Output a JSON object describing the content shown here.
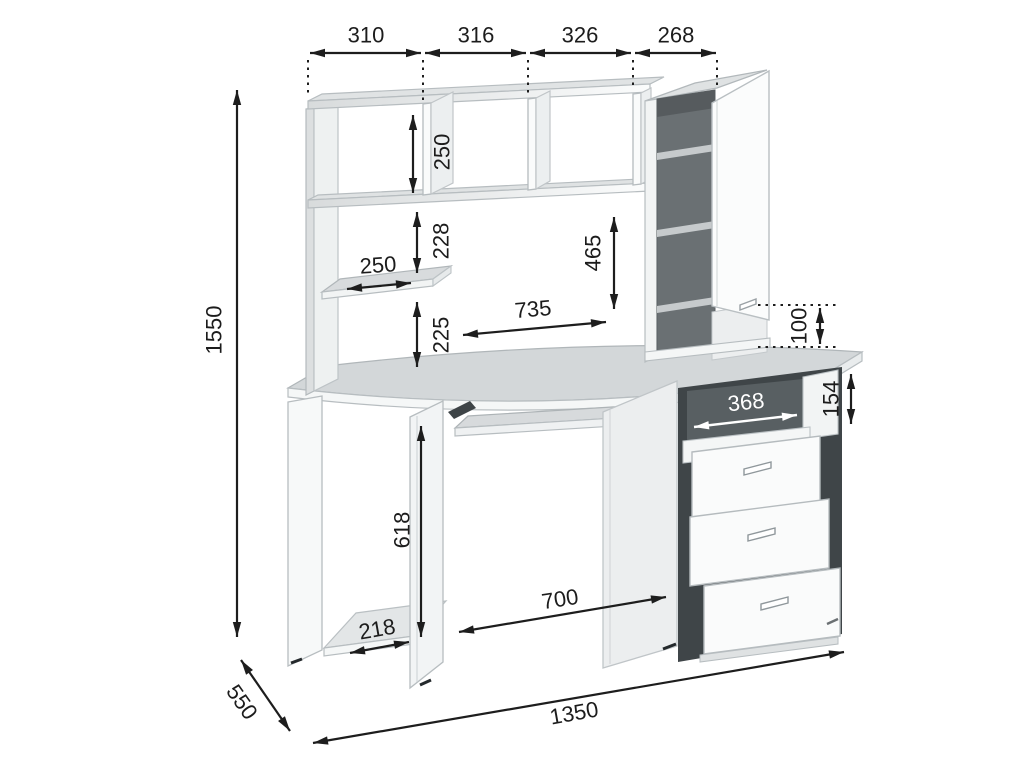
{
  "drawing": {
    "subject": "computer-desk-with-hutch-technical-drawing",
    "dims": {
      "top": [
        "310",
        "316",
        "326",
        "268"
      ],
      "height_total": "1550",
      "hutch_shelf_h": "250",
      "hutch_gap_upper": "228",
      "hutch_small_shelf_w": "250",
      "hutch_gap_lower": "225",
      "hutch_open_h": "465",
      "hutch_open_w": "735",
      "cabinet_gap": "100",
      "niche_w": "368",
      "niche_h": "154",
      "underdesk_h": "618",
      "kneehole_w": "700",
      "base_shelf_d": "218",
      "depth": "550",
      "width_total": "1350"
    },
    "colors": {
      "background": "#ffffff",
      "dimension_lines": "#1d1d1d",
      "panel_white": "#fafbfb",
      "desktop_gray": "#d3d7d9",
      "cabinet_interior": "#6a7073",
      "drawer_well_dark": "#3f4548",
      "niche_label": "#ffffff"
    }
  }
}
